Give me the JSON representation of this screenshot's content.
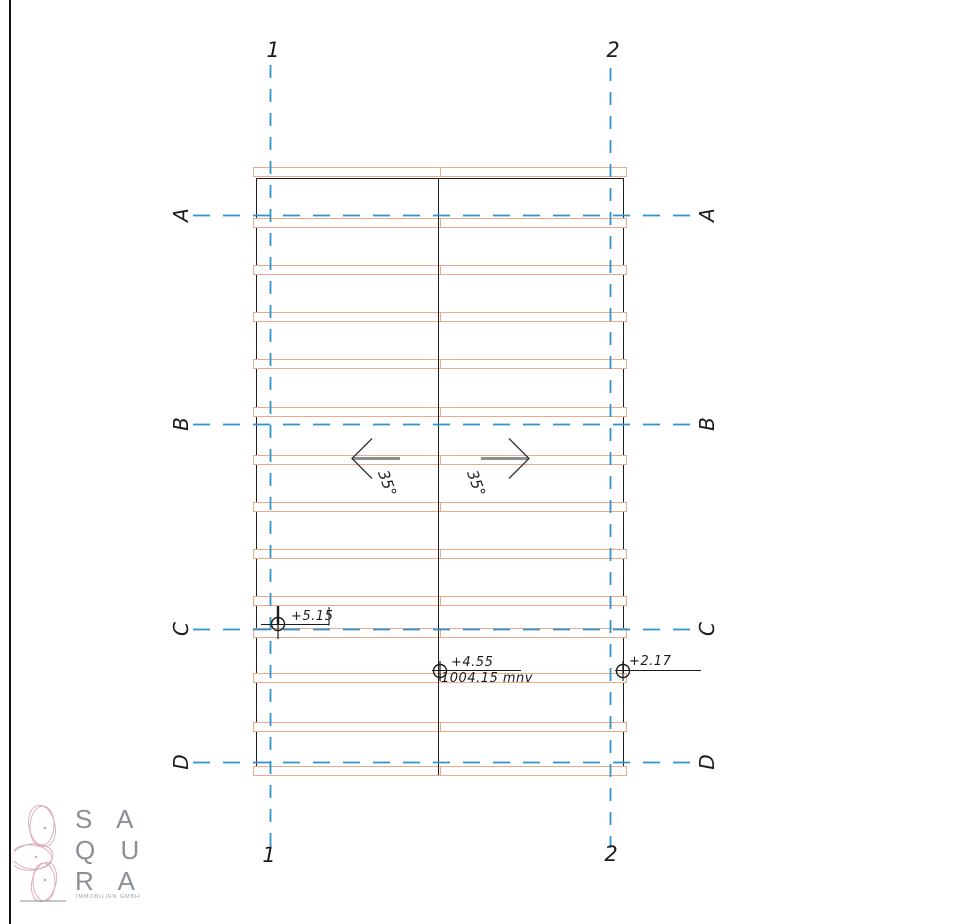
{
  "colors": {
    "grid_blue": "#2e93cc",
    "batten_orange": "#edaa8b",
    "line_black": "#1c1c1c",
    "arrow_gray": "#8f8f8f",
    "logo_pink": "#d9a8b8",
    "logo_gray": "#8a9099"
  },
  "grid": {
    "cols": [
      {
        "label": "1"
      },
      {
        "label": "2"
      }
    ],
    "rows": [
      {
        "label": "A"
      },
      {
        "label": "B"
      },
      {
        "label": "C"
      },
      {
        "label": "D"
      }
    ]
  },
  "slope": {
    "left_angle": "35°",
    "right_angle": "35°"
  },
  "elevation_markers": {
    "m1": {
      "value": "+5.15"
    },
    "m2": {
      "value": "+4.55",
      "datum": "1004.15 mnv"
    },
    "m3": {
      "value": "+2.17"
    }
  },
  "drawing": {
    "band_tops": [
      167,
      218,
      265,
      312,
      359,
      407,
      455,
      502,
      549,
      596,
      628,
      673,
      722,
      766
    ]
  },
  "logo": {
    "line1": "S A",
    "line2": "Q U",
    "line3": "R A",
    "tagline": "IMMOBILIEN GMBH"
  }
}
